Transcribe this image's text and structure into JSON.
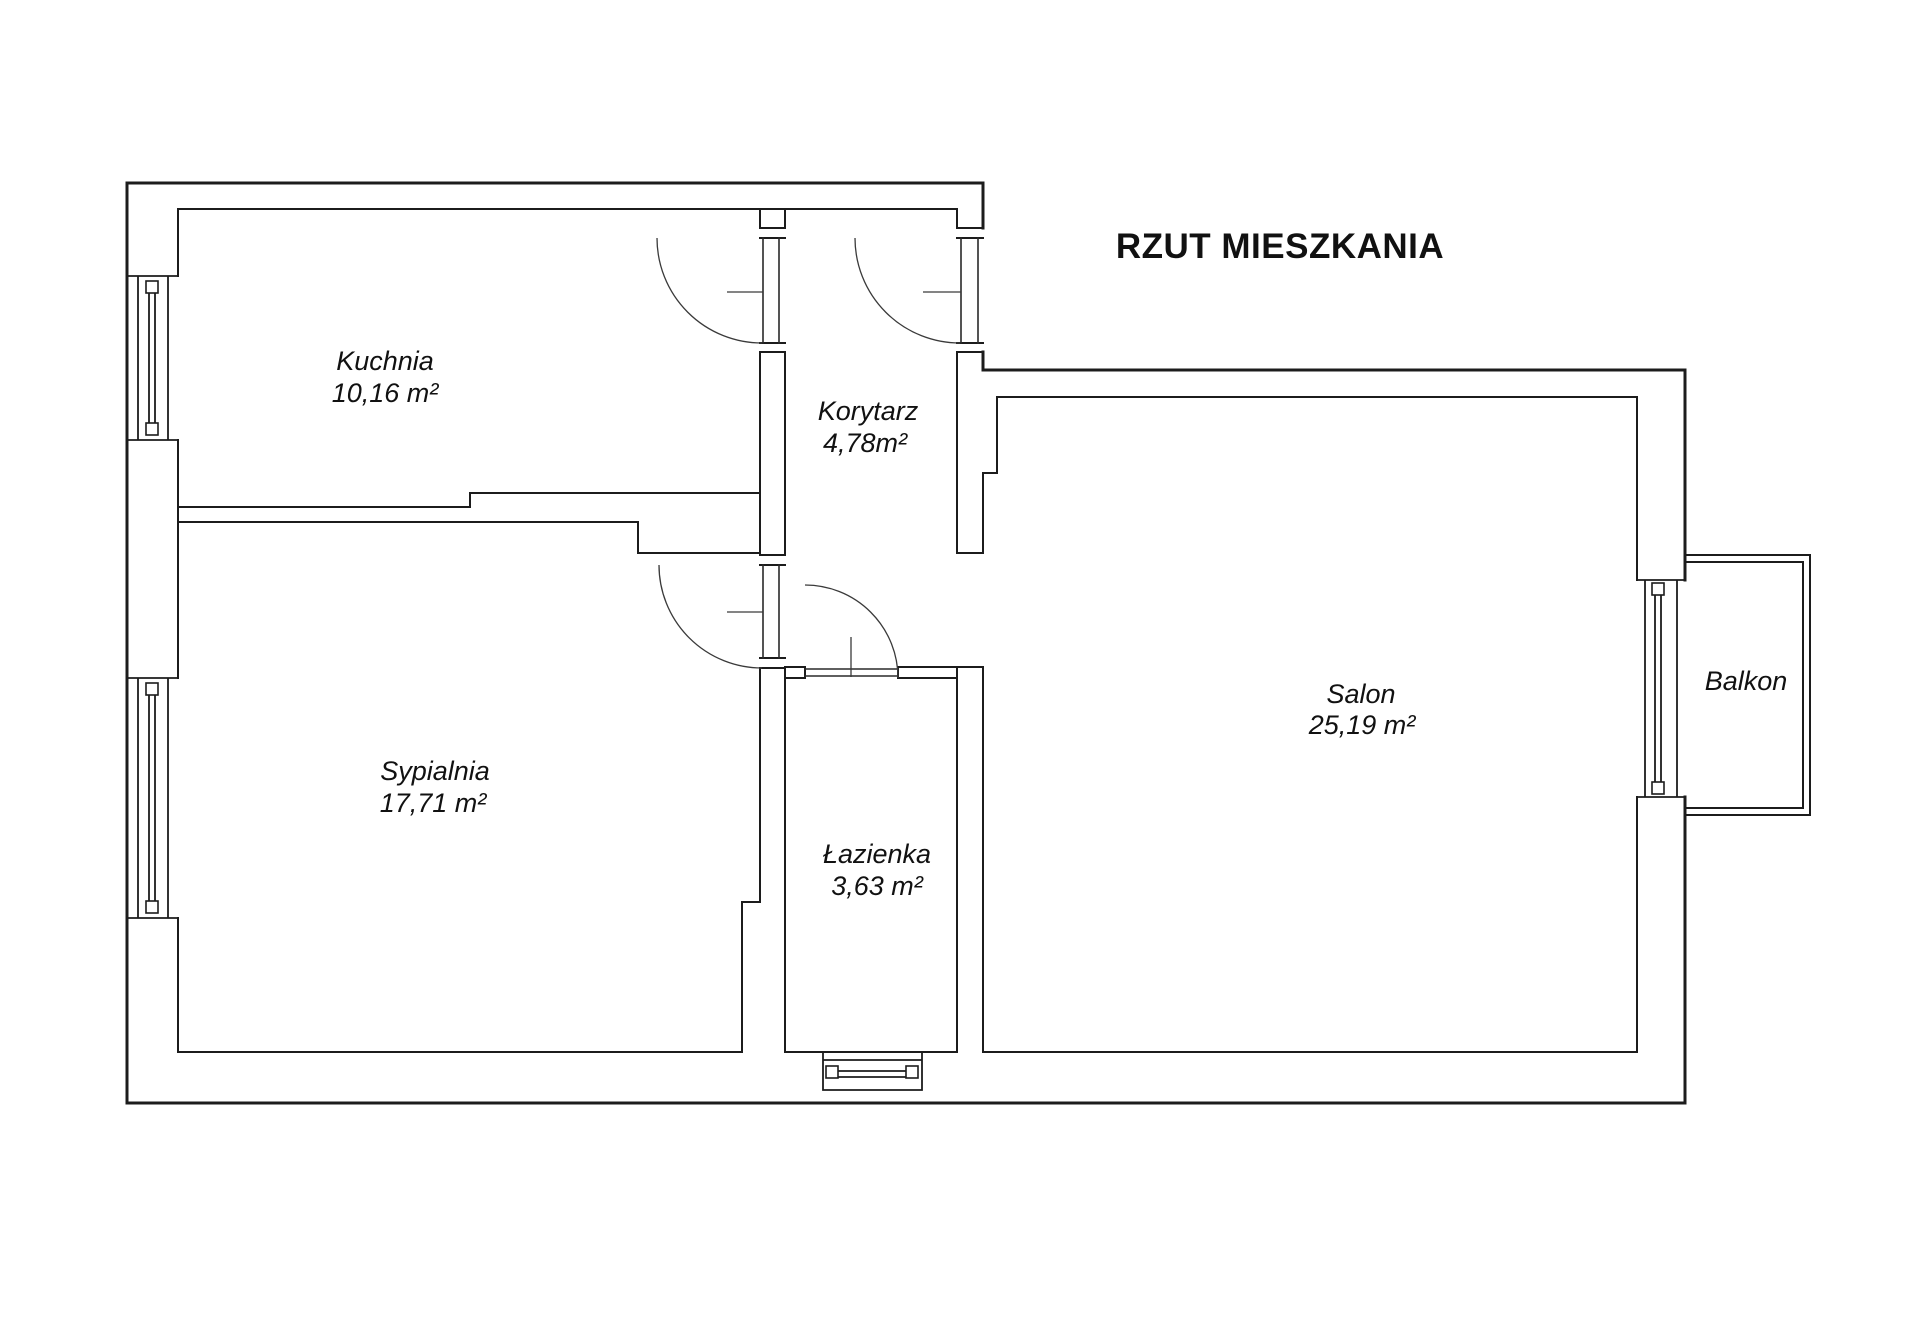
{
  "title": "RZUT MIESZKANIA",
  "rooms": [
    {
      "name": "Kuchnia",
      "area": "10,16 m²"
    },
    {
      "name": "Korytarz",
      "area": "4,78m²"
    },
    {
      "name": "Sypialnia",
      "area": "17,71 m²"
    },
    {
      "name": "Łazienka",
      "area": "3,63 m²"
    },
    {
      "name": "Salon",
      "area": "25,19 m²"
    },
    {
      "name": "Balkon",
      "area": ""
    }
  ],
  "colors": {
    "background": "#ffffff",
    "line": "#1c1c1c"
  }
}
